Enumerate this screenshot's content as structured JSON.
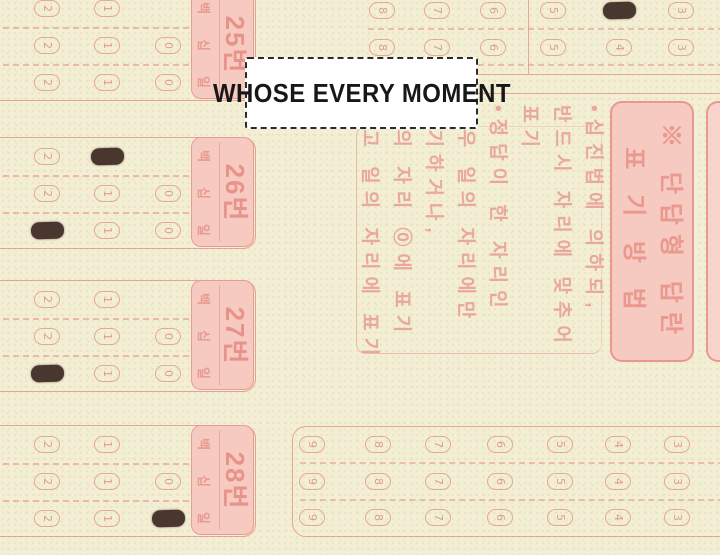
{
  "caption": {
    "text": "WHOSE EVERY MOMENT"
  },
  "sheet": {
    "marking_guide_box": {
      "title_line1": "※ 단답형 답란",
      "title_line2": "표 기 방 법"
    },
    "instructions": {
      "lines": [
        "•십진법에 의하되,",
        "반드시 자리에 맞추어",
        "표기",
        "•정답이 한 자리인",
        "경우 일의 자리에만",
        "표기하거나,",
        "십의 자리 ⓪에 표기",
        "하고 일의 자리에 표기"
      ]
    },
    "digit_place_labels": [
      "백",
      "십",
      "일"
    ],
    "answer_blocks": [
      {
        "label": "25번",
        "rows": [
          {
            "place": "백",
            "digits": [
              2,
              1
            ],
            "marked": null
          },
          {
            "place": "십",
            "digits": [
              2,
              1,
              0
            ],
            "marked": null
          },
          {
            "place": "일",
            "digits": [
              2,
              1,
              0
            ],
            "marked": null
          }
        ]
      },
      {
        "label": "26번",
        "rows": [
          {
            "place": "백",
            "digits": [
              2,
              1
            ],
            "marked": 1
          },
          {
            "place": "십",
            "digits": [
              2,
              1,
              0
            ],
            "marked": null
          },
          {
            "place": "일",
            "digits": [
              2,
              1,
              0
            ],
            "marked": 2
          }
        ]
      },
      {
        "label": "27번",
        "rows": [
          {
            "place": "백",
            "digits": [
              2,
              1
            ],
            "marked": null
          },
          {
            "place": "십",
            "digits": [
              2,
              1,
              0
            ],
            "marked": null
          },
          {
            "place": "일",
            "digits": [
              2,
              1,
              0
            ],
            "marked": 2
          }
        ]
      },
      {
        "label": "28번",
        "rows": [
          {
            "place": "백",
            "digits": [
              2,
              1
            ],
            "marked": null
          },
          {
            "place": "십",
            "digits": [
              2,
              1,
              0
            ],
            "marked": null
          },
          {
            "place": "일",
            "digits": [
              2,
              1,
              0
            ],
            "marked": 0
          }
        ]
      }
    ],
    "top_right_grid": {
      "rows": [
        {
          "digits": [
            8,
            7,
            6,
            5,
            4,
            3
          ],
          "marked": 4
        },
        {
          "digits": [
            8,
            7,
            6,
            5,
            4,
            3
          ],
          "marked": null
        }
      ]
    },
    "bottom_right_grid": {
      "rows": [
        {
          "digits": [
            9,
            8,
            7,
            6,
            5,
            4,
            3
          ],
          "marked": null
        },
        {
          "digits": [
            9,
            8,
            7,
            6,
            5,
            4,
            3
          ],
          "marked": null
        },
        {
          "digits": [
            9,
            8,
            7,
            6,
            5,
            4,
            3
          ],
          "marked": null
        }
      ]
    },
    "colors": {
      "paper": "#f2efd4",
      "ink_pink": "#e59a8e",
      "label_fill": "#f6c9c1",
      "mark": "#49362e",
      "caption_text": "#171717"
    }
  }
}
